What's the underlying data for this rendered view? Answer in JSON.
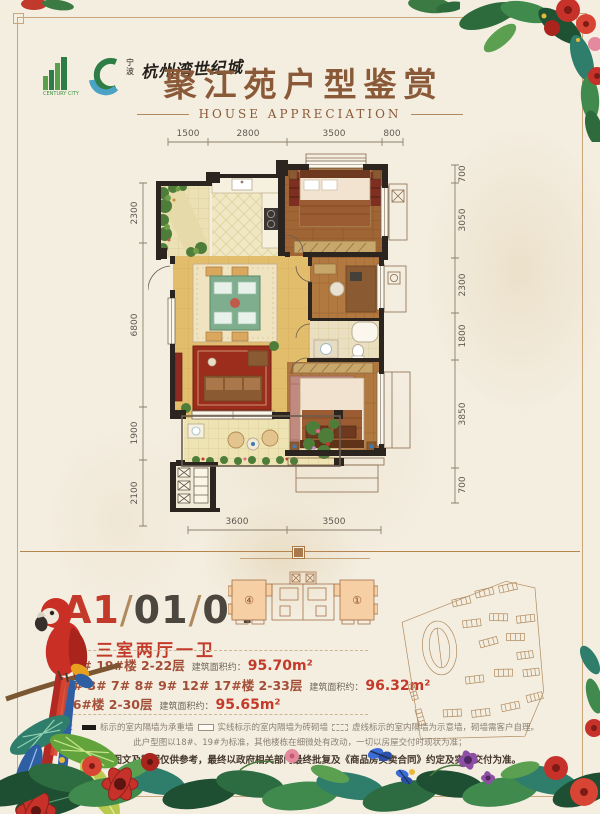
{
  "brand": {
    "name_en": "CENTURY CITY",
    "prefix_cn": "宁波",
    "name_cn": "杭州湾世纪城"
  },
  "header": {
    "title": "聚江苑户型鉴赏",
    "subtitle": "HOUSE APPRECIATION"
  },
  "plan": {
    "dims_top": [
      "1500",
      "2800",
      "3500",
      "800"
    ],
    "dims_left": [
      "2300",
      "6800",
      "1900",
      "2100"
    ],
    "dims_right": [
      "700",
      "3050",
      "2300",
      "1800",
      "3850",
      "700"
    ],
    "dims_bottom": [
      "3600",
      "3500"
    ]
  },
  "unit": {
    "code_main": "A1",
    "code_sep1": "/",
    "code_mid": "01",
    "code_sep2": "/",
    "code_end": "04",
    "layout": "三室两厅一卫",
    "lines": [
      {
        "buildings": "18# 19#楼  2-22层",
        "area_label": "建筑面积约：",
        "area": "95.70m²"
      },
      {
        "buildings": "2# 3# 7# 8# 9# 12# 17#楼  2-33层",
        "area_label": "建筑面积约：",
        "area": "96.32m²"
      },
      {
        "buildings": "16#楼  2-30层",
        "area_label": "建筑面积约：",
        "area": "95.65m²"
      }
    ]
  },
  "keyplan": {
    "unit_left": "④",
    "unit_right": "①"
  },
  "notes": {
    "legend_prefix": "注：",
    "legend_solid": "标示的室内隔墙为承重墙",
    "legend_open": "实线标示的室内隔墙为砖砌墙",
    "legend_dash": "虚线标示的室内隔墙为示意墙，砌墙需客户自理。",
    "note_line2": "此户型图以18#、19#为标准，其他楼栋在细微处有改动，一切以房屋交付时现状为准；",
    "note_line3": "*本户型图文及数据仅供参考，最终以政府相关部门最终批复及《商品房买卖合同》约定及实际交付为准。"
  },
  "colors": {
    "accent_red": "#c43a2a",
    "title_brown": "#8a5a38",
    "dim_text": "#5f584f",
    "wall_black": "#2b241f",
    "keyplan_fill": "#f6cfa4",
    "outline_brown": "#b08a5e"
  }
}
